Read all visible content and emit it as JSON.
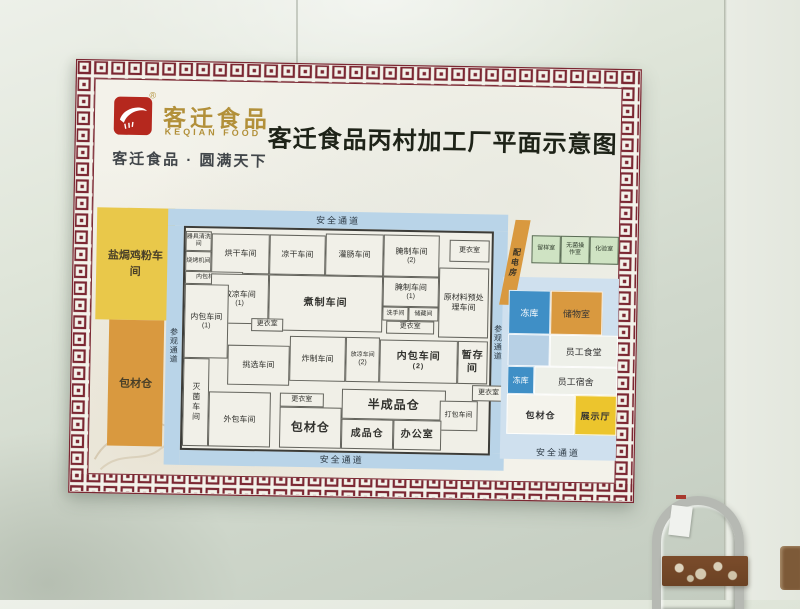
{
  "logo": {
    "brand_cn": "客迁食品",
    "brand_en": "KEQIAN FOOD",
    "registered": "®",
    "tagline": "客迁食品 · 圆满天下"
  },
  "title": "客迁食品丙村加工厂平面示意图",
  "colors": {
    "border_maroon": "#7b2732",
    "logo_red": "#b5281e",
    "gold": "#b2903a",
    "corridor_blue": "#b9d4e8",
    "yellow_block": "#e9c84a",
    "orange_block": "#d9993f",
    "freezer_blue": "#3f8fc6",
    "green_room": "#cfe3c3",
    "display_yellow": "#ecc52d"
  },
  "plan": {
    "corridor_top": "安全通道",
    "corridor_bottom": "安全通道",
    "corridor_right_bottom": "安全通道",
    "corridor_left": "参观通道",
    "corridor_right": "参观通道",
    "outer_left": {
      "block1": "盐焗鸡粉车间",
      "block2": "包材仓"
    },
    "rooms": [
      {
        "label": "器具清洗间"
      },
      {
        "label": "烧烤机间"
      },
      {
        "label": "烘干车间"
      },
      {
        "label": "凉干车间"
      },
      {
        "label": "灌肠车间"
      },
      {
        "label": "腌制车间",
        "sub": "(2)"
      },
      {
        "label": "更衣室"
      },
      {
        "label": "内包材缓冲间"
      },
      {
        "label": "放凉车间",
        "sub": "(1)"
      },
      {
        "label": "煮制车间"
      },
      {
        "label": "腌制车间",
        "sub": "(1)"
      },
      {
        "label": "洗手间"
      },
      {
        "label": "储藏间"
      },
      {
        "label": "更衣室"
      },
      {
        "label": "原材料预处理车间"
      },
      {
        "label": "内包车间",
        "sub": "(1)"
      },
      {
        "label": "灭菌车间"
      },
      {
        "label": "更衣室"
      },
      {
        "label": "挑选车间"
      },
      {
        "label": "炸制车间"
      },
      {
        "label": "放凉车间",
        "sub": "(2)"
      },
      {
        "label": "内包车间",
        "sub": "(2)"
      },
      {
        "label": "暂存间"
      },
      {
        "label": "外包车间"
      },
      {
        "label": "更衣室"
      },
      {
        "label": "包材仓"
      },
      {
        "label": "半成品仓"
      },
      {
        "label": "打包车间"
      },
      {
        "label": "更衣室"
      },
      {
        "label": "成品仓"
      },
      {
        "label": "办公室"
      }
    ],
    "right_area": {
      "slant_room": "配电房",
      "green_rooms": [
        "留样室",
        "无菌操作室",
        "化验室"
      ],
      "blocks": [
        {
          "label": "冻库"
        },
        {
          "label": "储物室"
        },
        {
          "label": "员工食堂"
        },
        {
          "label": "冻库"
        },
        {
          "label": "员工宿舍"
        },
        {
          "label": "包材仓"
        },
        {
          "label": "展示厅"
        }
      ]
    }
  }
}
